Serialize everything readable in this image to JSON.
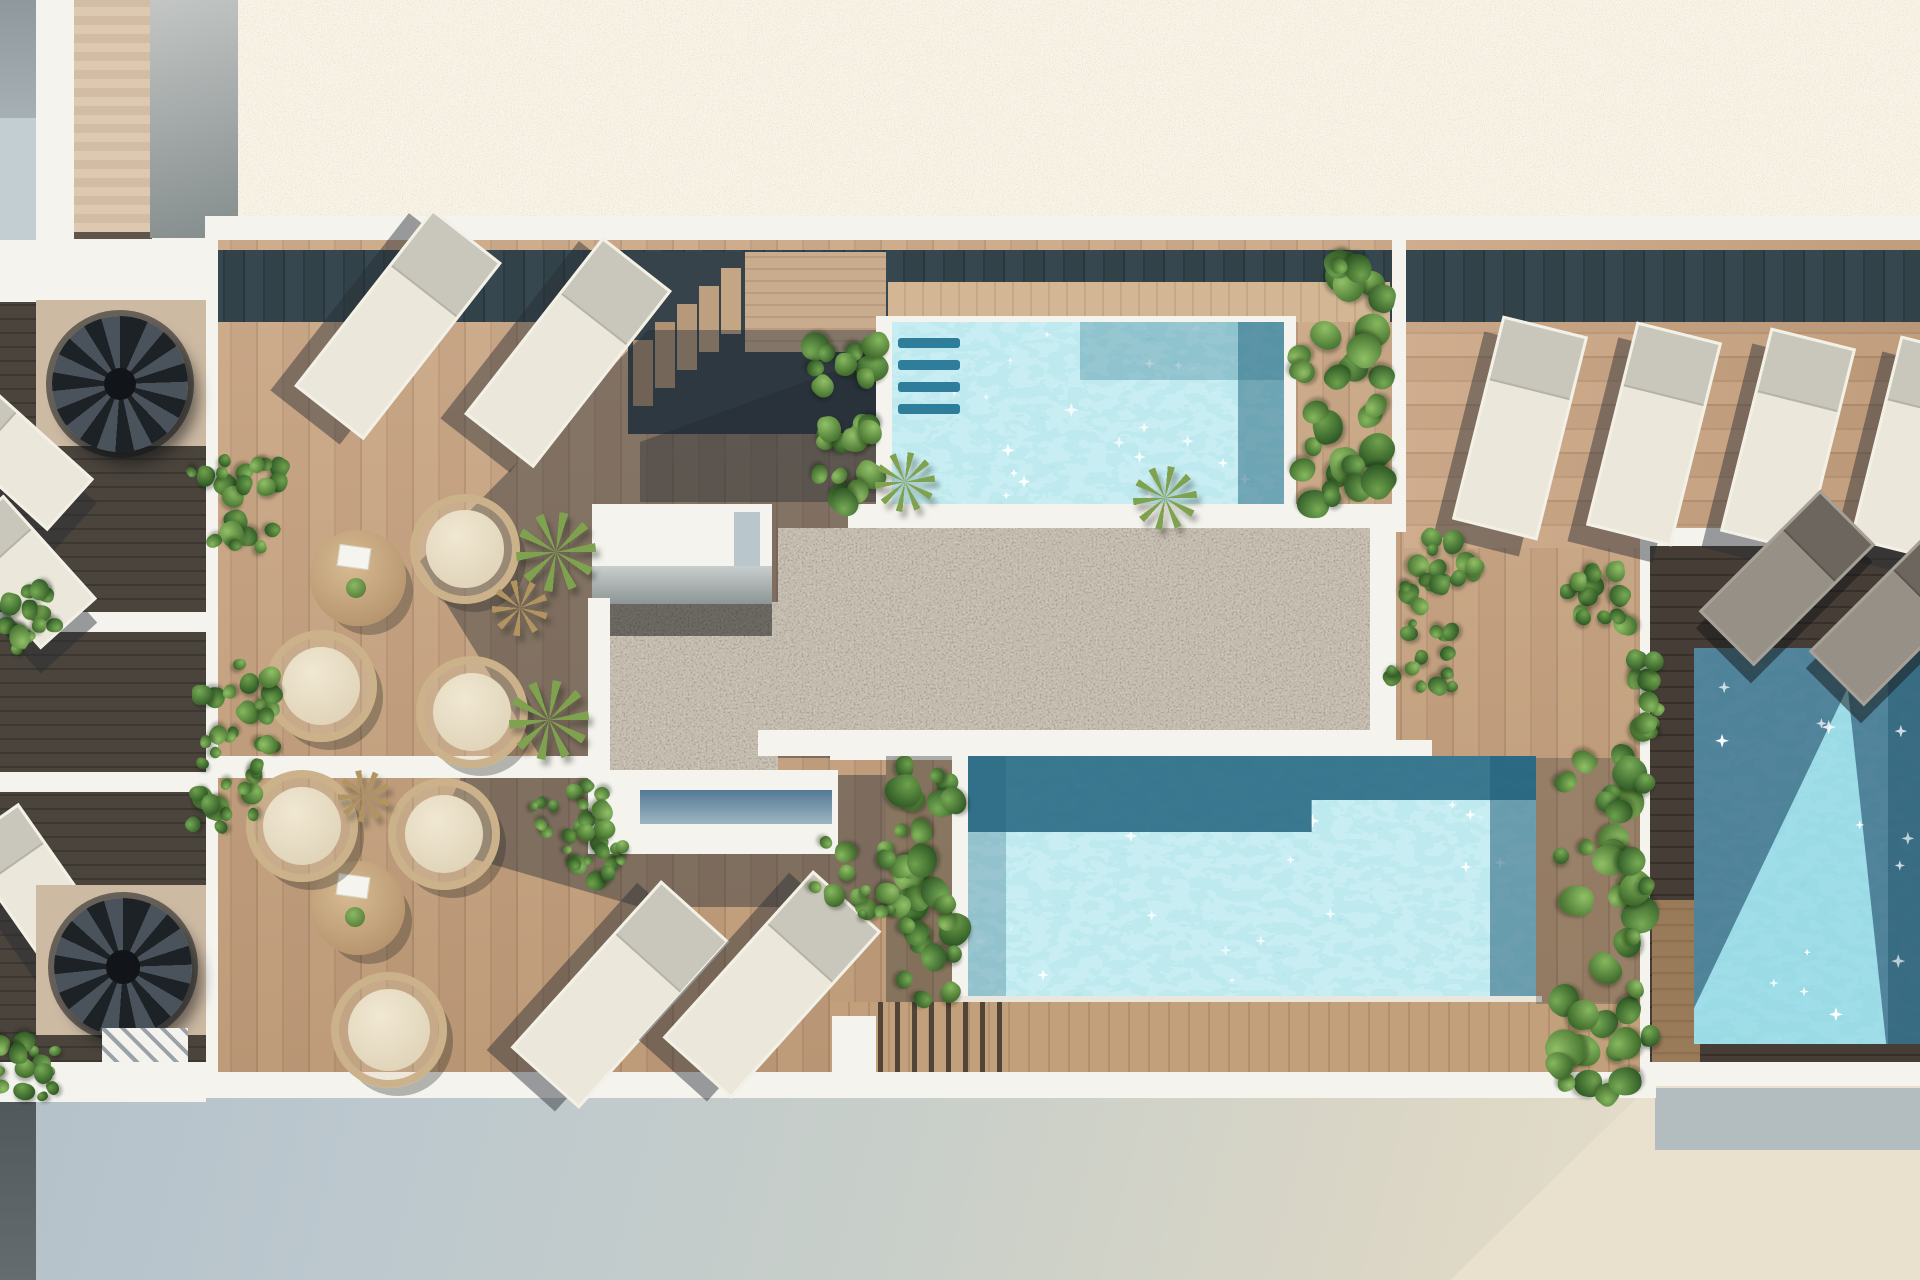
{
  "meta": {
    "type": "architectural-3d-render",
    "view": "top-down aerial",
    "subject": "rooftop pool terrace of a residential building"
  },
  "inventory": {
    "pools": 3,
    "sun_loungers": 13,
    "round_lounge_chairs": 6,
    "coffee_tables": 2,
    "spiral_staircases": 2,
    "wooden_step_flights": 2,
    "bushes": 9,
    "vine_planter_walls": 4,
    "yucca_plants": 4,
    "dried_grass_plants": 2
  },
  "areas": {
    "top": "gravel roof field",
    "left_strip": "lower-level service balconies with spiral stairs",
    "upper_deck": "wood deck with sun loungers and rattan lounge chairs",
    "pool_a": "upper plunge pool with underwater steps",
    "center": "dark pebble patio with white roof structure",
    "pool_b": "lower swimming pool with boardwalk",
    "pool_c": "right side pool in shadow",
    "right_deck": "lounger deck with four sun beds",
    "bottom": "street level in building shadow"
  },
  "palette": {
    "gravel": "#d9cfbe",
    "pebble": "#8d8173",
    "deck_wood": "#c5a17f",
    "shadow_wood": "#32424a",
    "espresso_wood": "#3f3933",
    "water_light": "#7ed0e0",
    "water_shadow": "#2e7796",
    "water_deep": "#2a607e",
    "coping_white": "#f4f3ee",
    "foliage": "#4a7733",
    "cushion": "#eae0c8",
    "ground_shade": "#b7c4cc",
    "ground_lit": "#e9e1ce"
  }
}
